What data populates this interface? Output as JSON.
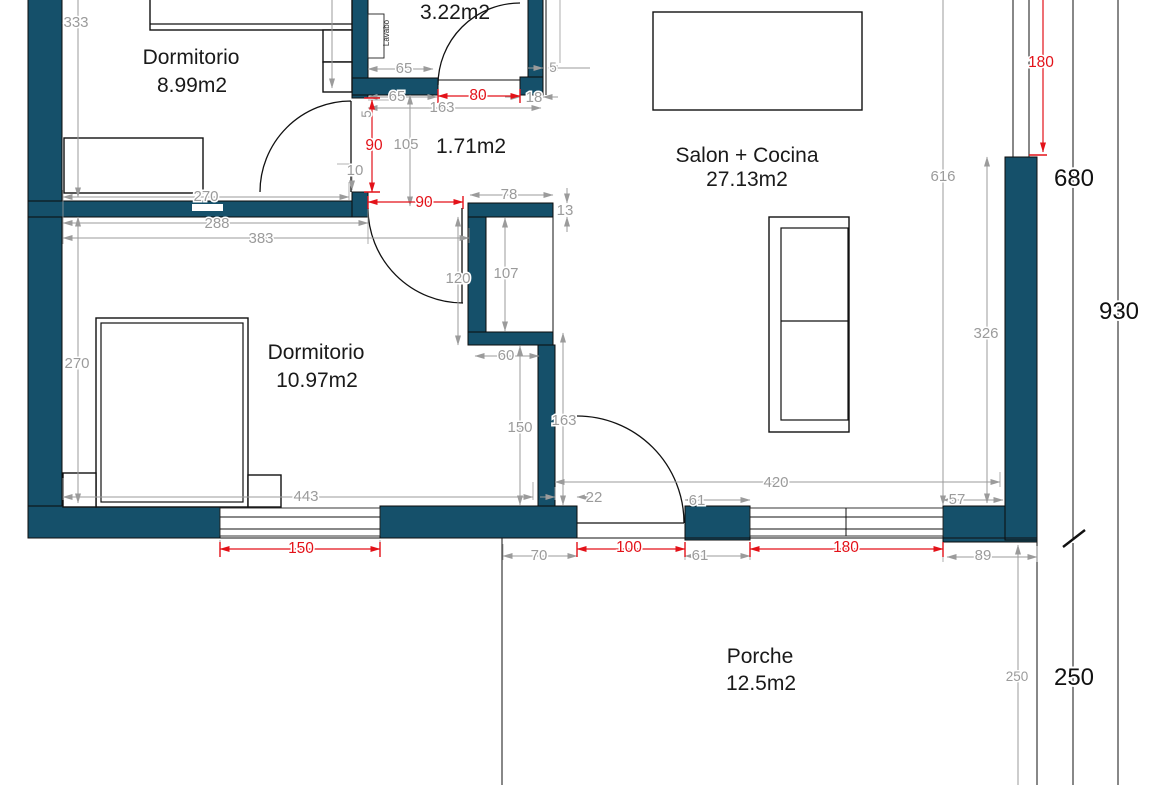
{
  "plan": {
    "title": "floor-plan",
    "rooms": [
      {
        "label": "Dormitorio",
        "area": "8.99m2"
      },
      {
        "area": "3.22m2"
      },
      {
        "area": "1.71m2"
      },
      {
        "label": "Salon + Cocina",
        "area": "27.13m2"
      },
      {
        "label": "Dormitorio",
        "area": "10.97m2"
      },
      {
        "label": "Porche",
        "area": "12.5m2"
      }
    ],
    "fixtures": {
      "sink_label": "Lavabo"
    },
    "dims_gray": [
      "333",
      "270",
      "288",
      "383",
      "270",
      "443",
      "65",
      "65",
      "5",
      "18",
      "163",
      "5",
      "105",
      "10",
      "78",
      "13",
      "120",
      "107",
      "60",
      "150",
      "163",
      "22",
      "70",
      "61",
      "61",
      "420",
      "57",
      "89",
      "616",
      "326",
      "250"
    ],
    "dims_red": [
      "90",
      "90",
      "80",
      "150",
      "100",
      "180",
      "180"
    ],
    "dims_black": [
      "680",
      "930",
      "250"
    ],
    "colors": {
      "wall": "#15506a",
      "dim_gray": "#9b9b9b",
      "dim_red": "#e31219",
      "line": "#111111",
      "background": "#ffffff"
    }
  }
}
